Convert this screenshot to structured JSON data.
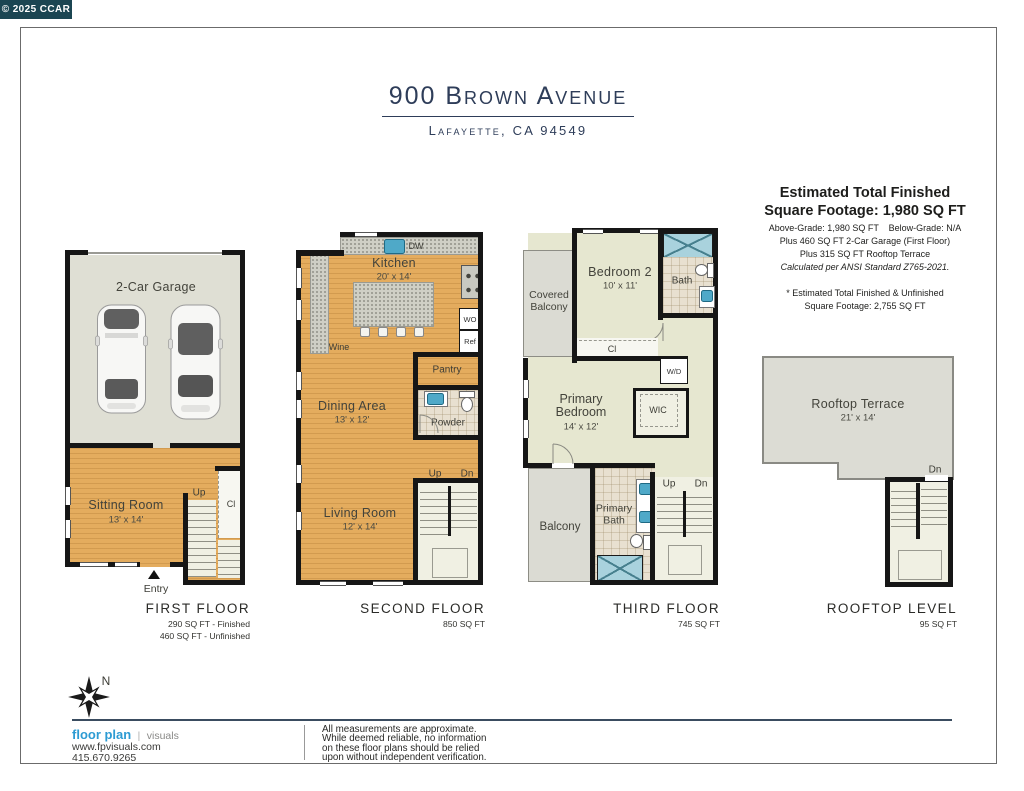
{
  "badge": {
    "text": "© 2025 CCAR"
  },
  "header": {
    "title": "900 Brown Avenue",
    "subtitle": "Lafayette, CA 94549"
  },
  "summary": {
    "title_line1": "Estimated Total Finished",
    "title_line2": "Square Footage: 1,980 SQ FT",
    "detail_lines": [
      "Above-Grade: 1,980 SQ FT    Below-Grade: N/A",
      "Plus 460 SQ FT 2-Car Garage (First Floor)",
      "Plus 315 SQ FT Rooftop Terrace",
      "Calculated per ANSI Standard Z765-2021."
    ],
    "note_line1": "* Estimated Total Finished & Unfinished",
    "note_line2": "Square Footage: 2,755 SQ FT"
  },
  "labels": {
    "up": "Up",
    "dn": "Dn",
    "cl": "Cl",
    "entry": "Entry",
    "dw": "DW",
    "wo": "WO",
    "ref": "Ref",
    "wine": "Wine",
    "wd": "W/D",
    "wic": "WIC",
    "north": "N"
  },
  "floors": {
    "first": {
      "title": "FIRST FLOOR",
      "area_lines": [
        "290 SQ FT - Finished",
        "460 SQ FT - Unfinished"
      ],
      "rooms": {
        "garage": {
          "name": "2-Car Garage"
        },
        "sitting": {
          "name": "Sitting Room",
          "dim": "13' x 14'"
        }
      }
    },
    "second": {
      "title": "SECOND FLOOR",
      "area_lines": [
        "850 SQ FT"
      ],
      "rooms": {
        "kitchen": {
          "name": "Kitchen",
          "dim": "20' x 14'"
        },
        "dining": {
          "name": "Dining Area",
          "dim": "13' x 12'"
        },
        "living": {
          "name": "Living Room",
          "dim": "12' x 14'"
        },
        "pantry": {
          "name": "Pantry"
        },
        "powder": {
          "name": "Powder"
        }
      }
    },
    "third": {
      "title": "THIRD FLOOR",
      "area_lines": [
        "745 SQ FT"
      ],
      "rooms": {
        "bedroom2": {
          "name": "Bedroom 2",
          "dim": "10' x 11'"
        },
        "bath": {
          "name": "Bath"
        },
        "covered_balcony": {
          "name": "Covered Balcony"
        },
        "primary_bedroom": {
          "name": "Primary Bedroom",
          "dim": "14' x 12'"
        },
        "balcony": {
          "name": "Balcony"
        },
        "primary_bath": {
          "name": "Primary Bath"
        }
      }
    },
    "rooftop": {
      "title": "ROOFTOP LEVEL",
      "area_lines": [
        "95 SQ FT"
      ],
      "rooms": {
        "terrace": {
          "name": "Rooftop Terrace",
          "dim": "21' x 14'"
        }
      }
    }
  },
  "footer": {
    "brand_bold": "floor plan",
    "brand_sep": "|",
    "brand_light": "visuals",
    "website": "www.fpvisuals.com",
    "phone": "415.670.9265",
    "disclaimer_lines": [
      "All measurements are approximate.",
      "While deemed reliable, no information",
      "on these floor plans should be relied",
      "upon without independent verification."
    ]
  },
  "colors": {
    "accent_navy": "#2E3D59",
    "brand_blue": "#2D9BD3",
    "badge_bg": "#1B4552",
    "wood": "#E4AC5E",
    "wall": "#161616"
  }
}
